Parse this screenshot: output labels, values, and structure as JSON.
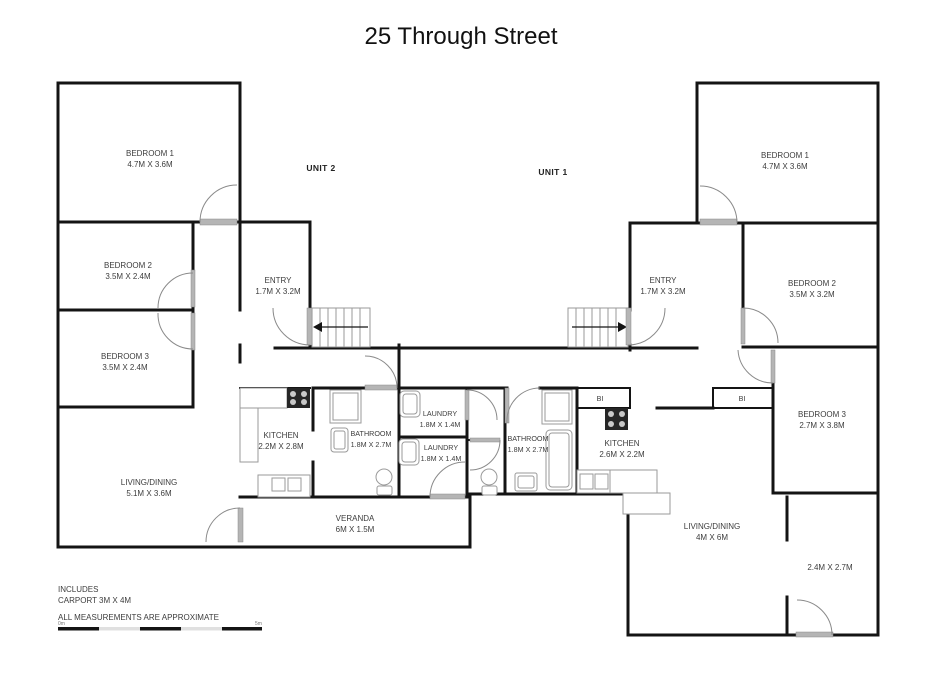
{
  "title": "25 Through Street",
  "unit_labels": {
    "unit2": "UNIT 2",
    "unit1": "UNIT 1"
  },
  "unit2": {
    "bedroom1": {
      "name": "BEDROOM 1",
      "dims": "4.7M X 3.6M"
    },
    "bedroom2": {
      "name": "BEDROOM 2",
      "dims": "3.5M X 2.4M"
    },
    "bedroom3": {
      "name": "BEDROOM 3",
      "dims": "3.5M X 2.4M"
    },
    "entry": {
      "name": "ENTRY",
      "dims": "1.7M X 3.2M"
    },
    "kitchen": {
      "name": "KITCHEN",
      "dims": "2.2M X 2.8M"
    },
    "bathroom": {
      "name": "BATHROOM",
      "dims": "1.8M X 2.7M"
    },
    "laundry": {
      "name": "LAUNDRY",
      "dims": "1.8M X 1.4M"
    },
    "living": {
      "name": "LIVING/DINING",
      "dims": "5.1M X 3.6M"
    },
    "veranda": {
      "name": "VERANDA",
      "dims": "6M X 1.5M"
    }
  },
  "unit1": {
    "bedroom1": {
      "name": "BEDROOM 1",
      "dims": "4.7M X 3.6M"
    },
    "bedroom2": {
      "name": "BEDROOM 2",
      "dims": "3.5M X 3.2M"
    },
    "bedroom3": {
      "name": "BEDROOM 3",
      "dims": "2.7M X 3.8M"
    },
    "entry": {
      "name": "ENTRY",
      "dims": "1.7M X 3.2M"
    },
    "kitchen": {
      "name": "KITCHEN",
      "dims": "2.6M X 2.2M"
    },
    "bathroom": {
      "name": "BATHROOM",
      "dims": "1.8M X 2.7M"
    },
    "laundry": {
      "name": "LAUNDRY",
      "dims": "1.8M X 1.4M"
    },
    "living": {
      "name": "LIVING/DINING",
      "dims": "4M X 6M"
    },
    "room24": {
      "dims": "2.4M X 2.7M"
    },
    "bi_kitchen": "BI",
    "bi_hall": "BI"
  },
  "notes": {
    "includes_line1": "INCLUDES",
    "includes_line2": "CARPORT 3M X 4M",
    "disclaimer": "ALL MEASUREMENTS ARE APPROXIMATE"
  },
  "scale_bar": {
    "start_label": "0m",
    "end_label": "5m"
  },
  "colors": {
    "wall": "#141414",
    "fixture": "#9a9a9a",
    "door_leaf": "#b5b5b5"
  }
}
